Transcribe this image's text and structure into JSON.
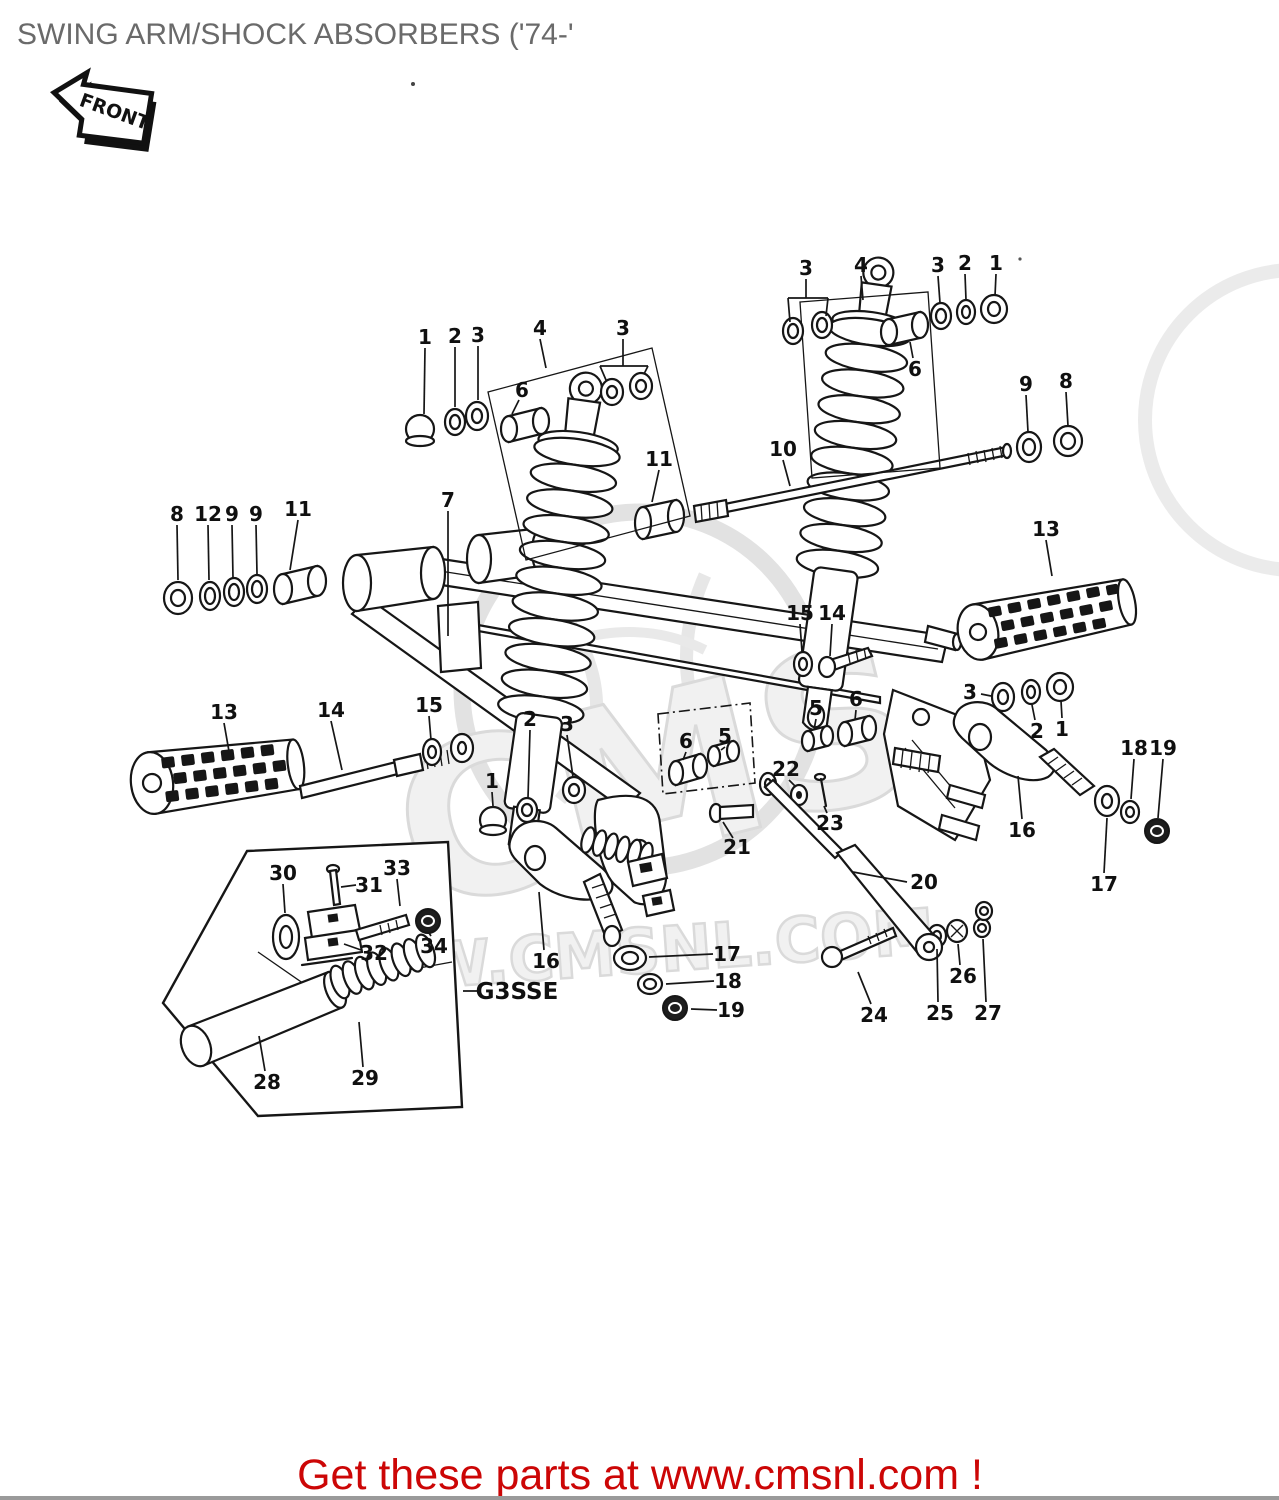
{
  "header": {
    "title": "SWING ARM/SHOCK ABSORBERS ('74-'",
    "front_badge": "FRONT"
  },
  "footer": {
    "message": "Get these parts at www.cmsnl.com !"
  },
  "watermark": {
    "logo_text": "CMS",
    "domain_text": "WWW.CMSNL.COM"
  },
  "colors": {
    "title": "#6a6a6a",
    "footer_red": "#cc0606",
    "line": "#161616",
    "watermark": "#dcdcdc"
  },
  "diagram": {
    "inset_code": "G3SSE",
    "labels": [
      {
        "t": "1",
        "x": 425,
        "y": 337,
        "lines": [
          [
            425,
            348,
            424,
            414
          ]
        ]
      },
      {
        "t": "2",
        "x": 455,
        "y": 336,
        "lines": [
          [
            455,
            347,
            455,
            407
          ]
        ]
      },
      {
        "t": "3",
        "x": 478,
        "y": 335,
        "lines": [
          [
            478,
            346,
            478,
            400
          ]
        ]
      },
      {
        "t": "4",
        "x": 540,
        "y": 328,
        "lines": [
          [
            540,
            339,
            546,
            368
          ]
        ]
      },
      {
        "t": "3",
        "x": 623,
        "y": 328,
        "lines": [
          [
            623,
            339,
            623,
            366
          ],
          [
            600,
            366,
            648,
            366
          ],
          [
            600,
            366,
            606,
            380
          ],
          [
            648,
            366,
            644,
            374
          ]
        ]
      },
      {
        "t": "6",
        "x": 522,
        "y": 390,
        "lines": [
          [
            519,
            400,
            512,
            414
          ]
        ]
      },
      {
        "t": "7",
        "x": 448,
        "y": 500,
        "lines": [
          [
            448,
            511,
            448,
            636
          ]
        ]
      },
      {
        "t": "8",
        "x": 177,
        "y": 514,
        "lines": [
          [
            177,
            525,
            178,
            580
          ]
        ]
      },
      {
        "t": "12",
        "x": 208,
        "y": 514,
        "lines": [
          [
            208,
            525,
            209,
            580
          ]
        ]
      },
      {
        "t": "9",
        "x": 232,
        "y": 514,
        "lines": [
          [
            232,
            525,
            233,
            578
          ]
        ]
      },
      {
        "t": "9",
        "x": 256,
        "y": 514,
        "lines": [
          [
            256,
            525,
            257,
            574
          ]
        ]
      },
      {
        "t": "11",
        "x": 298,
        "y": 509,
        "lines": [
          [
            298,
            520,
            290,
            570
          ]
        ]
      },
      {
        "t": "11",
        "x": 659,
        "y": 459,
        "lines": [
          [
            659,
            470,
            652,
            502
          ]
        ]
      },
      {
        "t": "10",
        "x": 783,
        "y": 449,
        "lines": [
          [
            783,
            460,
            790,
            486
          ]
        ]
      },
      {
        "t": "3",
        "x": 806,
        "y": 268,
        "lines": [
          [
            806,
            279,
            806,
            298
          ],
          [
            788,
            298,
            828,
            298
          ],
          [
            788,
            298,
            790,
            322
          ],
          [
            828,
            298,
            826,
            316
          ]
        ]
      },
      {
        "t": "4",
        "x": 861,
        "y": 265,
        "lines": [
          [
            861,
            276,
            863,
            300
          ]
        ]
      },
      {
        "t": "3",
        "x": 938,
        "y": 265,
        "lines": [
          [
            938,
            276,
            940,
            303
          ]
        ]
      },
      {
        "t": "2",
        "x": 965,
        "y": 263,
        "lines": [
          [
            965,
            274,
            966,
            300
          ]
        ]
      },
      {
        "t": "1",
        "x": 996,
        "y": 263,
        "lines": [
          [
            996,
            274,
            995,
            296
          ]
        ]
      },
      {
        "t": "6",
        "x": 915,
        "y": 369,
        "lines": [
          [
            913,
            358,
            910,
            342
          ]
        ]
      },
      {
        "t": "9",
        "x": 1026,
        "y": 384,
        "lines": [
          [
            1026,
            395,
            1028,
            432
          ]
        ]
      },
      {
        "t": "8",
        "x": 1066,
        "y": 381,
        "lines": [
          [
            1066,
            392,
            1068,
            426
          ]
        ]
      },
      {
        "t": "13",
        "x": 1046,
        "y": 529,
        "lines": [
          [
            1046,
            540,
            1052,
            576
          ]
        ]
      },
      {
        "t": "15",
        "x": 800,
        "y": 613,
        "lines": [
          [
            800,
            624,
            802,
            652
          ]
        ]
      },
      {
        "t": "14",
        "x": 832,
        "y": 613,
        "lines": [
          [
            832,
            624,
            830,
            656
          ]
        ]
      },
      {
        "t": "13",
        "x": 224,
        "y": 712,
        "lines": [
          [
            224,
            723,
            230,
            757
          ]
        ]
      },
      {
        "t": "14",
        "x": 331,
        "y": 710,
        "lines": [
          [
            331,
            721,
            342,
            770
          ]
        ]
      },
      {
        "t": "15",
        "x": 429,
        "y": 705,
        "lines": [
          [
            429,
            716,
            431,
            740
          ]
        ]
      },
      {
        "t": "2",
        "x": 530,
        "y": 719,
        "lines": [
          [
            530,
            730,
            528,
            798
          ]
        ]
      },
      {
        "t": "3",
        "x": 567,
        "y": 724,
        "lines": [
          [
            567,
            735,
            573,
            777
          ]
        ]
      },
      {
        "t": "1",
        "x": 492,
        "y": 781,
        "lines": [
          [
            492,
            792,
            493,
            806
          ]
        ]
      },
      {
        "t": "6",
        "x": 686,
        "y": 741,
        "lines": [
          [
            686,
            752,
            683,
            760
          ]
        ]
      },
      {
        "t": "5",
        "x": 725,
        "y": 736,
        "lines": [
          [
            725,
            747,
            721,
            750
          ]
        ]
      },
      {
        "t": "5",
        "x": 816,
        "y": 708,
        "lines": [
          [
            816,
            719,
            814,
            730
          ]
        ]
      },
      {
        "t": "6",
        "x": 856,
        "y": 699,
        "lines": [
          [
            856,
            710,
            855,
            720
          ]
        ]
      },
      {
        "t": "22",
        "x": 786,
        "y": 769,
        "lines": [
          [
            789,
            780,
            796,
            787
          ]
        ]
      },
      {
        "t": "21",
        "x": 737,
        "y": 847,
        "lines": [
          [
            733,
            838,
            723,
            822
          ]
        ]
      },
      {
        "t": "23",
        "x": 830,
        "y": 823,
        "lines": [
          [
            827,
            813,
            824,
            806
          ]
        ]
      },
      {
        "t": "20",
        "x": 924,
        "y": 882,
        "lines": [
          [
            907,
            882,
            853,
            872
          ]
        ]
      },
      {
        "t": "16",
        "x": 546,
        "y": 961,
        "lines": [
          [
            544,
            950,
            539,
            892
          ]
        ]
      },
      {
        "t": "17",
        "x": 727,
        "y": 954,
        "lines": [
          [
            713,
            954,
            649,
            957
          ]
        ]
      },
      {
        "t": "18",
        "x": 728,
        "y": 981,
        "lines": [
          [
            714,
            981,
            666,
            984
          ]
        ]
      },
      {
        "t": "19",
        "x": 731,
        "y": 1010,
        "lines": [
          [
            717,
            1010,
            691,
            1009
          ]
        ]
      },
      {
        "t": "24",
        "x": 874,
        "y": 1015,
        "lines": [
          [
            871,
            1004,
            858,
            972
          ]
        ]
      },
      {
        "t": "25",
        "x": 940,
        "y": 1013,
        "lines": [
          [
            938,
            1002,
            937,
            949
          ]
        ]
      },
      {
        "t": "26",
        "x": 963,
        "y": 976,
        "lines": [
          [
            960,
            965,
            958,
            944
          ]
        ]
      },
      {
        "t": "27",
        "x": 988,
        "y": 1013,
        "lines": [
          [
            986,
            1002,
            983,
            939
          ]
        ]
      },
      {
        "t": "16",
        "x": 1022,
        "y": 830,
        "lines": [
          [
            1022,
            819,
            1018,
            776
          ]
        ]
      },
      {
        "t": "17",
        "x": 1104,
        "y": 884,
        "lines": [
          [
            1104,
            873,
            1107,
            818
          ]
        ]
      },
      {
        "t": "18",
        "x": 1134,
        "y": 748,
        "lines": [
          [
            1134,
            759,
            1131,
            799
          ]
        ]
      },
      {
        "t": "19",
        "x": 1163,
        "y": 748,
        "lines": [
          [
            1163,
            759,
            1158,
            818
          ]
        ]
      },
      {
        "t": "3",
        "x": 970,
        "y": 692,
        "lines": [
          [
            981,
            694,
            991,
            696
          ]
        ]
      },
      {
        "t": "2",
        "x": 1037,
        "y": 731,
        "lines": [
          [
            1035,
            720,
            1032,
            705
          ]
        ]
      },
      {
        "t": "1",
        "x": 1062,
        "y": 729,
        "lines": [
          [
            1062,
            718,
            1061,
            701
          ]
        ]
      },
      {
        "t": "30",
        "x": 283,
        "y": 873,
        "lines": [
          [
            283,
            884,
            285,
            913
          ]
        ]
      },
      {
        "t": "31",
        "x": 369,
        "y": 885,
        "lines": [
          [
            356,
            885,
            341,
            887
          ]
        ]
      },
      {
        "t": "33",
        "x": 397,
        "y": 868,
        "lines": [
          [
            397,
            879,
            400,
            906
          ]
        ]
      },
      {
        "t": "32",
        "x": 374,
        "y": 953,
        "lines": [
          [
            361,
            950,
            344,
            944
          ]
        ]
      },
      {
        "t": "34",
        "x": 434,
        "y": 946,
        "lines": [
          [
            431,
            936,
            429,
            933
          ]
        ]
      },
      {
        "t": "28",
        "x": 267,
        "y": 1082,
        "lines": [
          [
            265,
            1071,
            259,
            1036
          ]
        ]
      },
      {
        "t": "29",
        "x": 365,
        "y": 1078,
        "lines": [
          [
            363,
            1067,
            359,
            1022
          ]
        ]
      },
      {
        "t": "G3SSE",
        "x": 517,
        "y": 992,
        "s": 23,
        "lines": [
          [
            463,
            991,
            481,
            991
          ]
        ]
      }
    ]
  }
}
